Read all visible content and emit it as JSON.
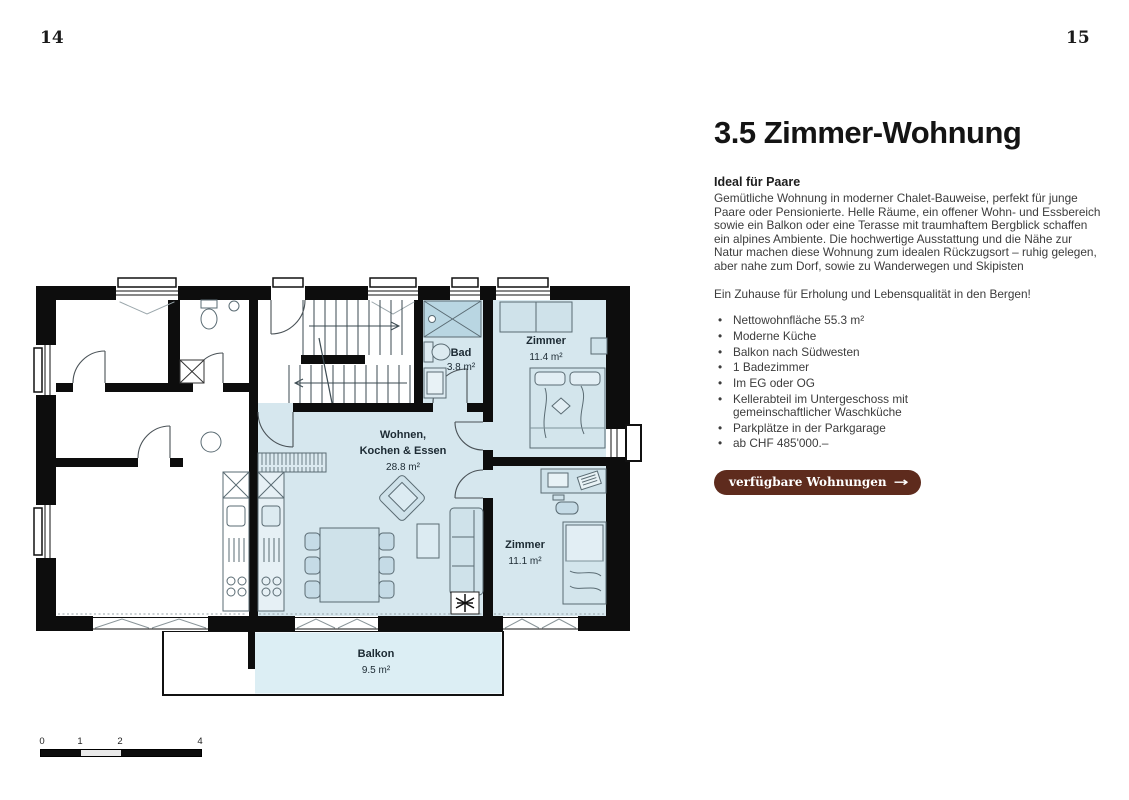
{
  "page": {
    "number_left": "14",
    "number_right": "15",
    "bullet_char": "•"
  },
  "article": {
    "title": "3.5 Zimmer-Wohnung",
    "subtitle": "Ideal für Paare",
    "paragraph": "Gemütliche Wohnung in moderner Chalet-Bauweise, perfekt für junge Paare oder Pensionierte. Helle Räume, ein offener Wohn- und Essbereich sowie ein Balkon oder eine Terasse mit traumhaftem Bergblick schaffen ein alpines Ambiente. Die hochwertige Ausstattung und die Nähe zur Natur machen diese Wohnung zum idealen Rückzugsort – ruhig gelegen, aber nahe zum Dorf, sowie zu Wanderwegen und Skipisten",
    "highlight": "Ein Zuhause für Erholung und Lebensqualität in den Bergen!",
    "bullets": [
      "Nettowohnfläche 55.3 m²",
      "Moderne Küche",
      "Balkon nach Südwesten",
      "1 Badezimmer",
      "Im EG oder OG",
      "Kellerabteil im Untergeschoss mit gemeinschaftlicher Waschküche",
      "Parkplätze in der Parkgarage",
      "ab CHF 485'000.–"
    ],
    "cta_label": "verfügbare Wohnungen",
    "cta_arrow": "→"
  },
  "floorplan": {
    "rooms": {
      "bad": {
        "name": "Bad",
        "area": "3.8 m²"
      },
      "zimmer1": {
        "name": "Zimmer",
        "area": "11.4 m²"
      },
      "living": {
        "name_line1": "Wohnen,",
        "name_line2": "Kochen & Essen",
        "area": "28.8 m²"
      },
      "zimmer2": {
        "name": "Zimmer",
        "area": "11.1 m²"
      },
      "balkon": {
        "name": "Balkon",
        "area": "9.5 m²"
      }
    },
    "scale": {
      "ticks": [
        "0",
        "1",
        "2",
        "4"
      ]
    },
    "colors": {
      "wall": "#0d0d0d",
      "room_fill": "#d6e7ee",
      "balcony_fill": "#dceef4",
      "accent_button": "#5e2b1d"
    }
  }
}
